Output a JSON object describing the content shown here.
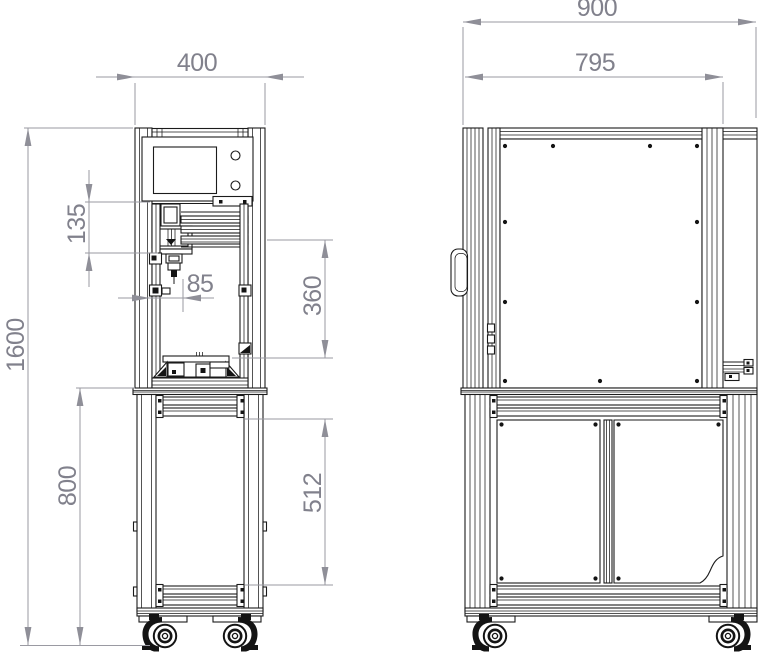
{
  "drawing": {
    "background": "#ffffff",
    "line_color": "#1b1b1b",
    "dimension_line_color": "#9a9aa2",
    "dimension_text_color": "#81818c"
  },
  "dimensions": {
    "front_width": "400",
    "overall_height": "1600",
    "head_offset": "135",
    "nozzle_offset": "85",
    "work_area_height": "360",
    "stand_height": "800",
    "stand_opening_height": "512",
    "overall_depth": "900",
    "enclosure_depth": "795"
  }
}
